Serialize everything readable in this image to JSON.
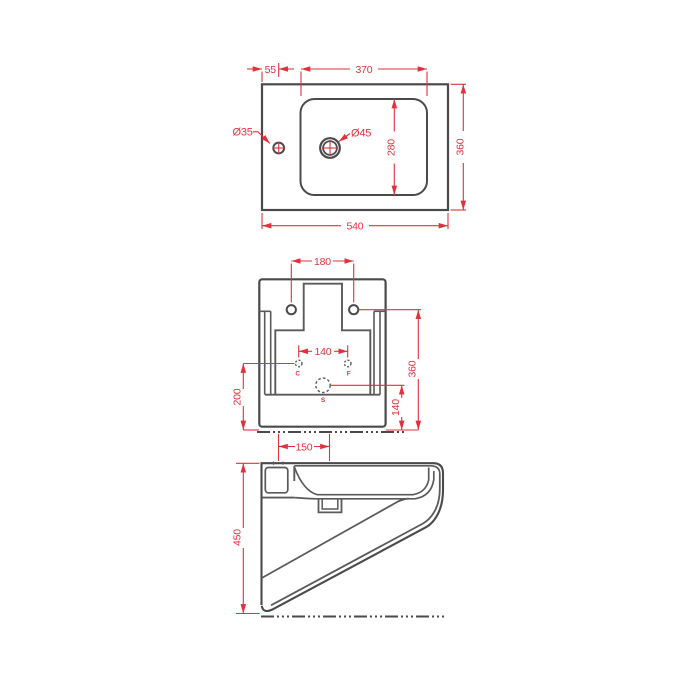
{
  "drawing": {
    "kind": "sanitary-ware technical drawing, three orthographic views",
    "colors": {
      "line": "#4a4a4a",
      "dimension": "#e0323c",
      "background": "#ffffff"
    },
    "views": {
      "top": {
        "dims": {
          "faucet_offset": "55",
          "basin_width": "370",
          "overall_depth": "360",
          "basin_depth": "280",
          "overall_width": "540",
          "faucet_hole": "Ø35",
          "drain_hole": "Ø45"
        }
      },
      "rear": {
        "dims": {
          "mount_hole_spacing": "180",
          "supply_spacing": "140",
          "mount_height": "360",
          "supply_height": "200",
          "drain_height": "140"
        },
        "labels": {
          "c": "C",
          "f": "F",
          "s": "S"
        }
      },
      "side": {
        "dims": {
          "faucet_to_drain": "150",
          "overall_height": "450"
        }
      }
    }
  }
}
